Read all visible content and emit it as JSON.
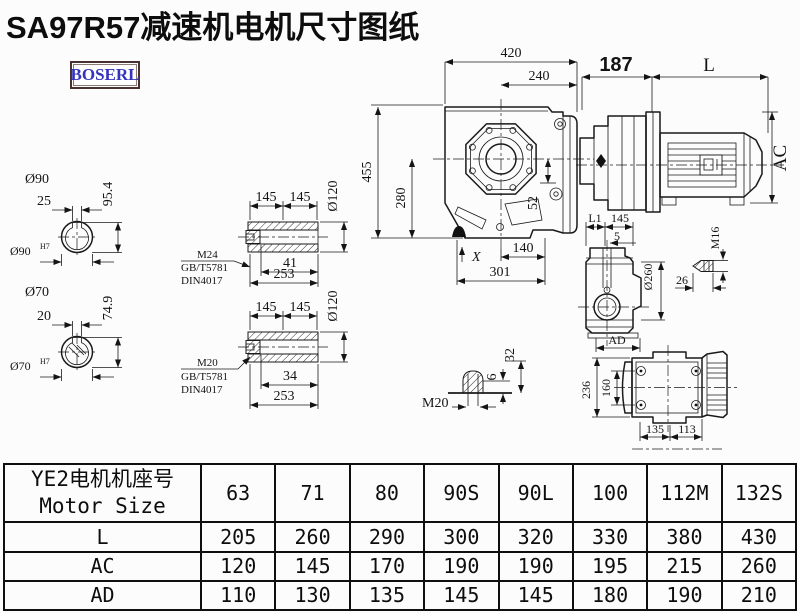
{
  "title": "SA97R57减速机电机尺寸图纸",
  "logo": "BOSERL",
  "colors": {
    "title": "#0d0d0d",
    "logo_text": "#3434bd",
    "logo_border": "#4a3230",
    "line": "#1a1a1a"
  },
  "drawing": {
    "front": {
      "w420": "420",
      "w240": "240",
      "adapter187": "187",
      "L": "L",
      "AC": "AC",
      "h455": "455",
      "h280": "280",
      "v52": "52",
      "X": "X",
      "f140": "140",
      "f301": "301"
    },
    "shaft90": {
      "dia": "Ø90",
      "key": "25",
      "h": "95.4",
      "bore": "Ø90",
      "tol": "H7"
    },
    "shaft70": {
      "dia": "Ø70",
      "key": "20",
      "h": "74.9",
      "bore": "Ø70",
      "tol": "H7"
    },
    "hollow1": {
      "a": "145",
      "b": "145",
      "dia": "Ø120",
      "thread": "M24",
      "std1": "GB/T5781",
      "std2": "DIN4017",
      "key": "41",
      "len": "253"
    },
    "hollow2": {
      "a": "145",
      "b": "145",
      "dia": "Ø120",
      "thread": "M20",
      "std1": "GB/T5781",
      "std2": "DIN4017",
      "key": "34",
      "len": "253"
    },
    "boltM20": {
      "label": "M20",
      "d6": "6",
      "d32": "32"
    },
    "side": {
      "L1": "L1",
      "a145": "145",
      "off5": "5",
      "dia": "Ø260",
      "AD": "AD"
    },
    "boltM16": {
      "label": "M16",
      "len": "26"
    },
    "bottom": {
      "h236": "236",
      "h160": "160",
      "w135": "135",
      "w113": "113"
    }
  },
  "table": {
    "header_cn": "YE2电机机座号",
    "header_en": "Motor Size",
    "columns": [
      "63",
      "71",
      "80",
      "90S",
      "90L",
      "100",
      "112M",
      "132S"
    ],
    "rows": [
      {
        "label": "L",
        "values": [
          "205",
          "260",
          "290",
          "300",
          "320",
          "330",
          "380",
          "430"
        ]
      },
      {
        "label": "AC",
        "values": [
          "120",
          "145",
          "170",
          "190",
          "190",
          "195",
          "215",
          "260"
        ]
      },
      {
        "label": "AD",
        "values": [
          "110",
          "130",
          "135",
          "145",
          "145",
          "180",
          "190",
          "210"
        ]
      }
    ]
  }
}
